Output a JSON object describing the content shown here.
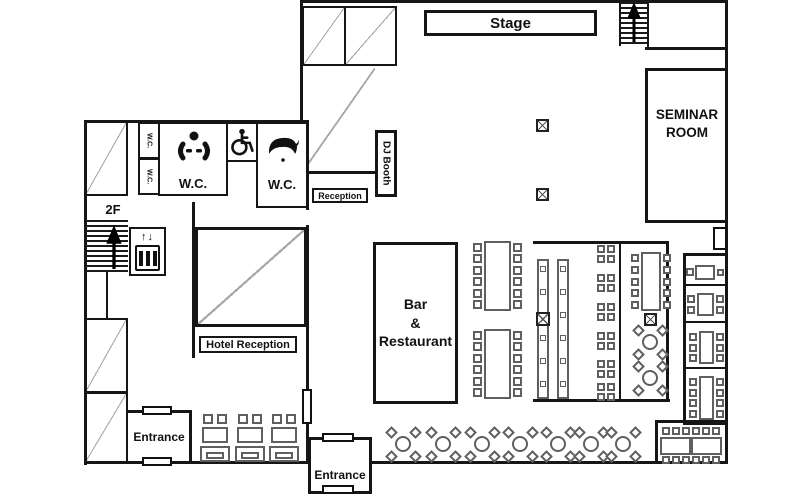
{
  "app": {
    "type": "venue-floor-plan"
  },
  "labels": {
    "stage": "Stage",
    "seminar_room": "SEMINAR\nROOM",
    "dj_booth": "DJ Booth",
    "reception": "Reception",
    "hotel_reception": "Hotel Reception",
    "bar_restaurant": "Bar\n&\nRestaurant",
    "wc_main": "W.C.",
    "wc_right": "W.C.",
    "wc_small_top": "W.C.",
    "wc_small_bottom": "W.C.",
    "floor_2f": "2F",
    "elevator_arrows": "↑↓",
    "entrance_west": "Entrance",
    "entrance_south": "Entrance"
  },
  "icons": {
    "stairs_up_arrow": "up-arrow",
    "wheelchair": "wheelchair-accessible",
    "female_wc": "person-silhouette",
    "male_wc": "hair-silhouette",
    "elevator": "elevator-doors",
    "pillar": "x-cross-pillar"
  },
  "colors": {
    "wall": "#161616",
    "furniture": "#5f5f5f",
    "hatch": "#a8a8a8",
    "background": "#ffffff",
    "text": "#111111"
  }
}
